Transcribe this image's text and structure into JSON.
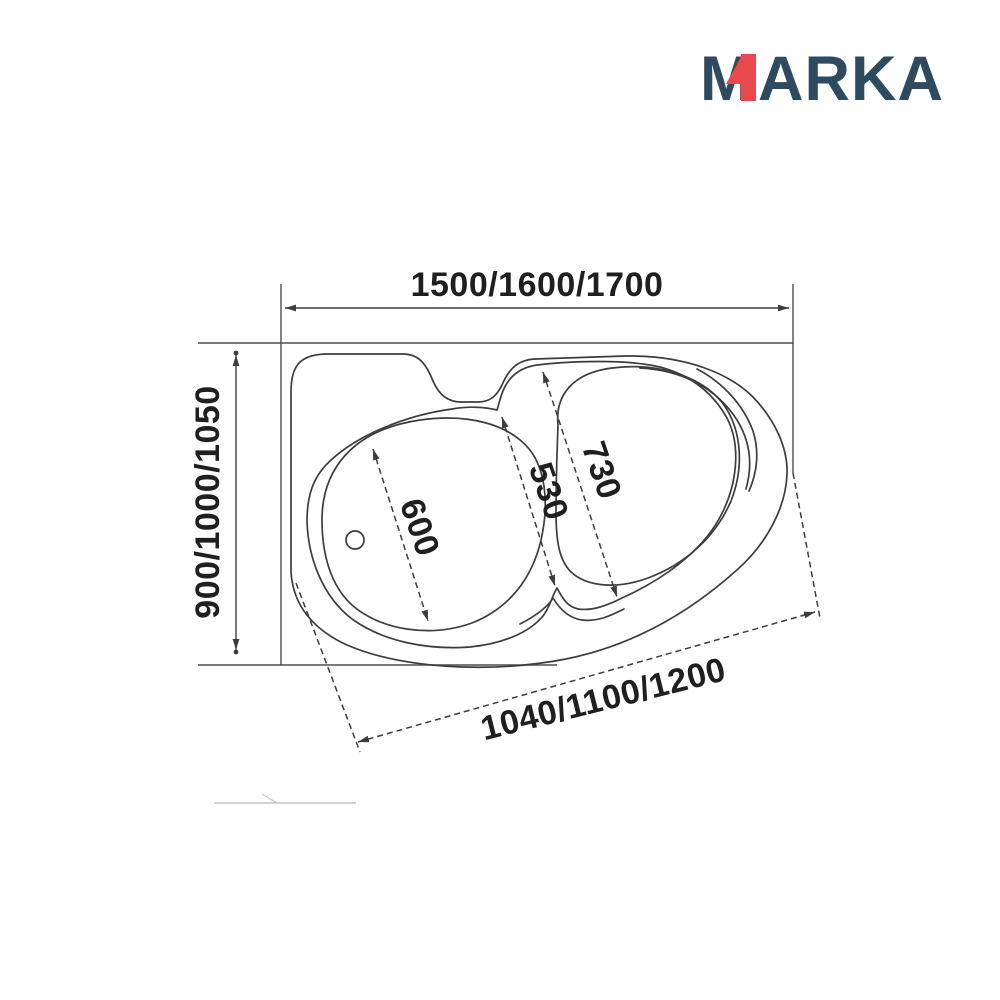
{
  "logo": {
    "letter_m": "M",
    "rest": "ARKA",
    "navy": "#2e4a5f",
    "red": "#e8494d"
  },
  "dimensions": {
    "overall_width": "1500/1600/1700",
    "overall_depth": "900/1000/1050",
    "front_edge": "1040/1100/1200",
    "left_basin_width": "600",
    "middle_width": "530",
    "right_basin_width": "730"
  },
  "colors": {
    "line": "#3d3d3d",
    "wall": "#4f4f4f",
    "text": "#1f1f1f",
    "faint": "#c4c4c4"
  }
}
